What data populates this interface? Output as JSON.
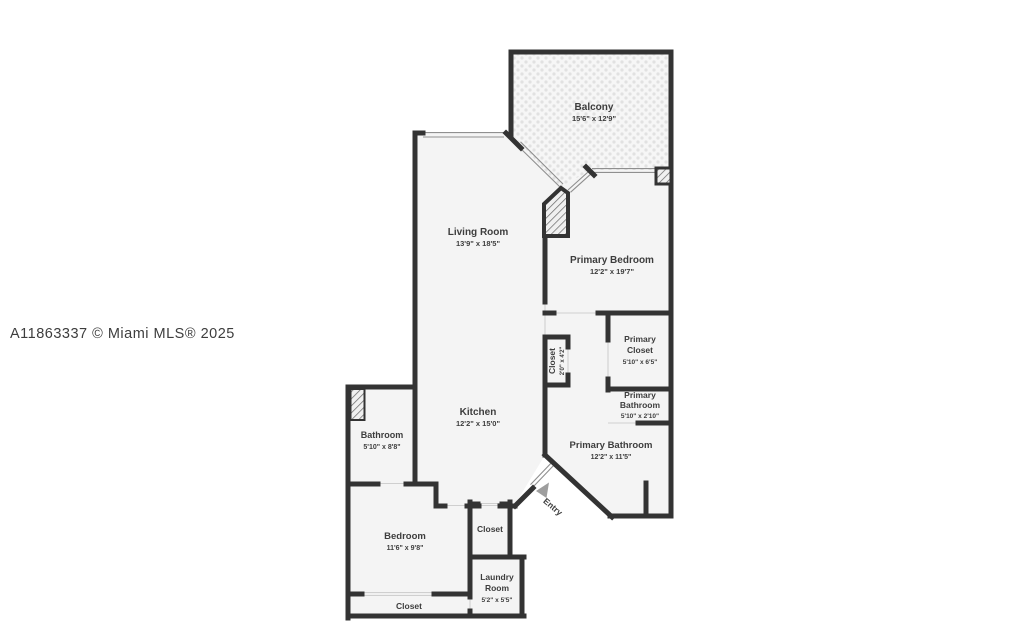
{
  "watermark": "A11863337 © Miami MLS® 2025",
  "colors": {
    "wall": "#333333",
    "floor": "#f4f4f4",
    "label_text": "#3d3d3d",
    "watermark_text": "#b9bdc3",
    "entry_arrow": "#9e9e9e"
  },
  "rooms": {
    "balcony": {
      "name": "Balcony",
      "dims": "15'6\" x 12'9\""
    },
    "living_room": {
      "name": "Living Room",
      "dims": "13'9\" x 18'5\""
    },
    "primary_bedroom": {
      "name": "Primary Bedroom",
      "dims": "12'2\" x 19'7\""
    },
    "hall_closet": {
      "name": "Closet",
      "dims": "2'0\" x 4'2\""
    },
    "primary_closet": {
      "name": "Primary",
      "name2": "Closet",
      "dims": "5'10\" x 6'5\""
    },
    "primary_bathroom_small": {
      "name": "Primary",
      "name2": "Bathroom",
      "dims": "5'10\" x 2'10\""
    },
    "primary_bathroom": {
      "name": "Primary Bathroom",
      "dims": "12'2\" x 11'5\""
    },
    "kitchen": {
      "name": "Kitchen",
      "dims": "12'2\" x 15'0\""
    },
    "bathroom": {
      "name": "Bathroom",
      "dims": "5'10\" x 8'8\""
    },
    "bedroom": {
      "name": "Bedroom",
      "dims": "11'6\" x 9'8\""
    },
    "middle_closet": {
      "name": "Closet"
    },
    "laundry_room": {
      "name": "Laundry",
      "name2": "Room",
      "dims": "5'2\" x 5'5\""
    },
    "bedroom_closet": {
      "name": "Closet"
    },
    "entry": {
      "name": "Entry"
    }
  }
}
